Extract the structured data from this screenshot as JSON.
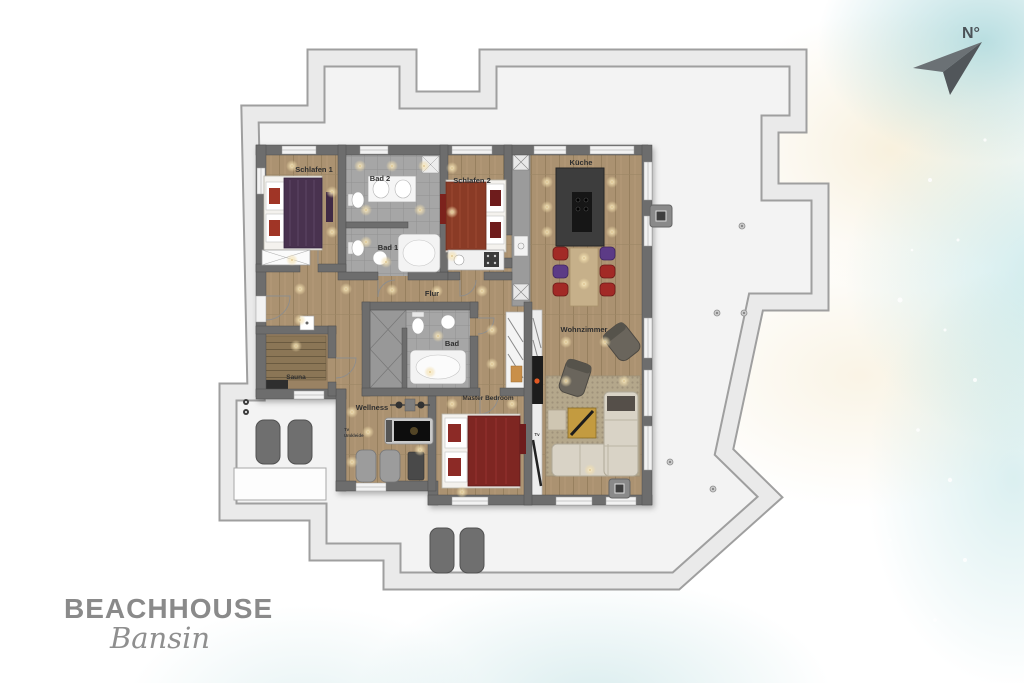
{
  "logo": {
    "brand": "BEACHHOUSE",
    "location": "Bansin"
  },
  "compass": {
    "north_label": "N°"
  },
  "rooms": {
    "schlafen1": "Schlafen 1",
    "bad2": "Bad 2",
    "bad1": "Bad 1",
    "schlafen2": "Schlafen 2",
    "kueche": "Küche",
    "flur": "Flur",
    "bad": "Bad",
    "sauna": "Sauna",
    "wellness": "Wellness",
    "tv_wellness": "Tv",
    "umkleide": "Umkleide",
    "master_bedroom": "Master Bedroom",
    "tv_living": "Tv",
    "wohnzimmer": "Wohnzimmer"
  },
  "colors": {
    "terrace_band": "#e9e9e9",
    "walls": "#6d6d6d",
    "wood_floor": "#ab9271",
    "tile_floor": "#a8a8a8",
    "bed_purple": "#4a3350",
    "bed_red": "#7e2523",
    "stool_red": "#a22c28",
    "stool_purple": "#5c3a86",
    "sofa_beige": "#d9d3c6",
    "logo_gray": "#8a8a8a",
    "watercolor_teal": "#9fd0d3",
    "watercolor_sand": "#f1e6cb"
  }
}
